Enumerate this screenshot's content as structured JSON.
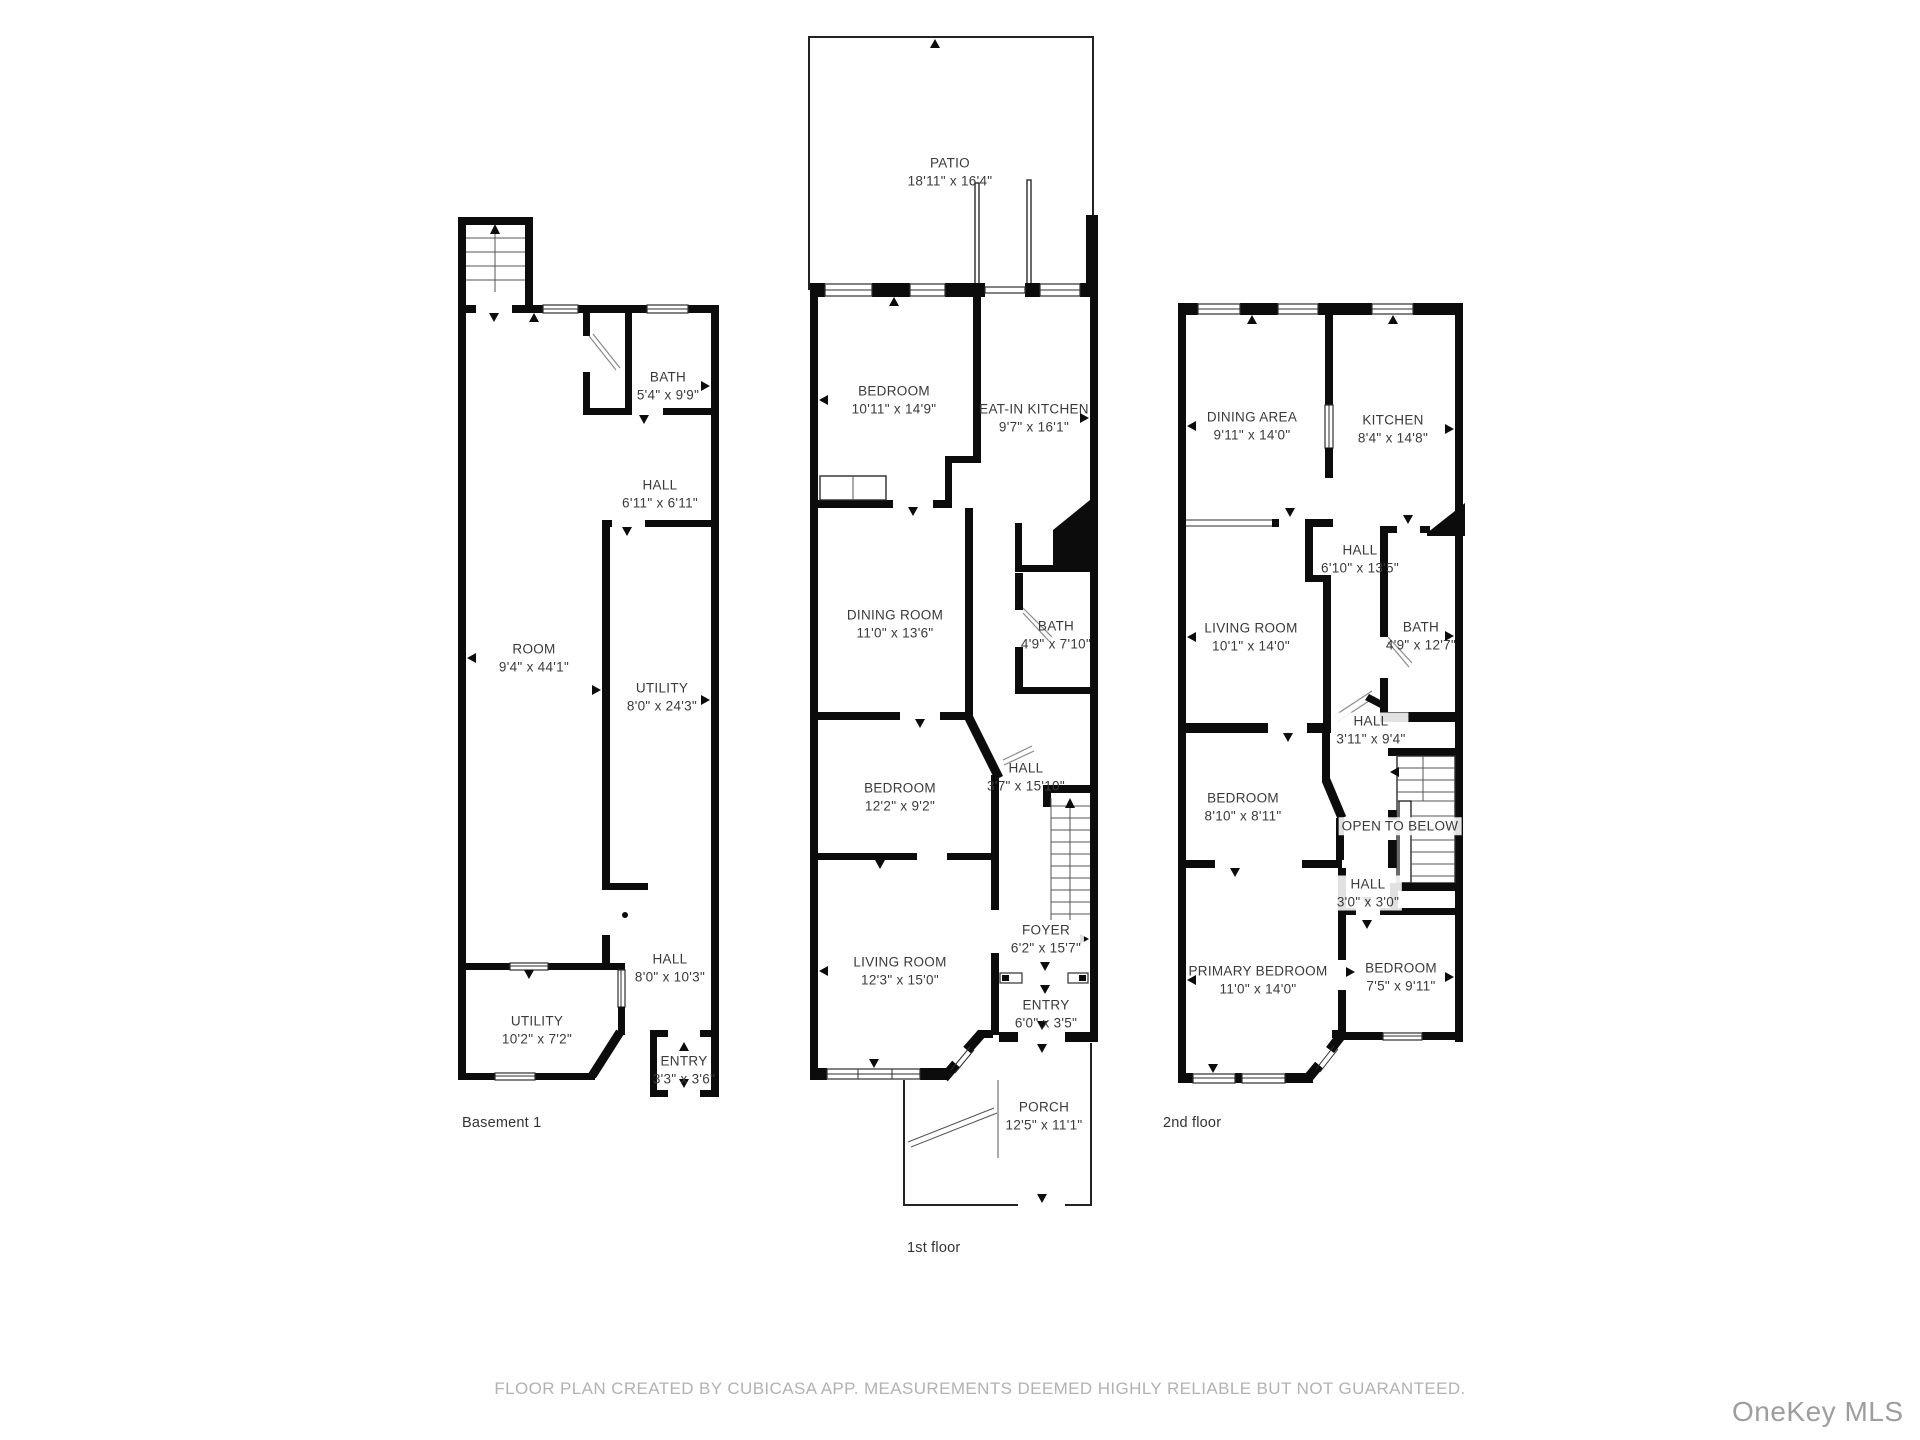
{
  "page": {
    "footer_disclaimer": "FLOOR PLAN CREATED BY CUBICASA APP. MEASUREMENTS DEEMED HIGHLY RELIABLE BUT NOT GUARANTEED.",
    "watermark": "OneKey MLS",
    "colors": {
      "wall": "#0c0c0c",
      "text": "#3a3a3a",
      "muted_text": "#b2b2b2",
      "watermark_text": "#9e9e9e",
      "background": "#ffffff"
    }
  },
  "plans": [
    {
      "floor_label": "Basement 1",
      "rooms": [
        {
          "name": "BATH",
          "dims": "5'4\" x 9'9\""
        },
        {
          "name": "HALL",
          "dims": "6'11\" x 6'11\""
        },
        {
          "name": "ROOM",
          "dims": "9'4\" x 44'1\""
        },
        {
          "name": "UTILITY",
          "dims": "8'0\" x 24'3\""
        },
        {
          "name": "HALL",
          "dims": "8'0\" x 10'3\""
        },
        {
          "name": "UTILITY",
          "dims": "10'2\" x 7'2\""
        },
        {
          "name": "ENTRY",
          "dims": "3'3\" x 3'6\""
        }
      ]
    },
    {
      "floor_label": "1st floor",
      "rooms": [
        {
          "name": "PATIO",
          "dims": "18'11\" x 16'4\""
        },
        {
          "name": "BEDROOM",
          "dims": "10'11\" x 14'9\""
        },
        {
          "name": "EAT-IN KITCHEN",
          "dims": "9'7\" x 16'1\""
        },
        {
          "name": "DINING ROOM",
          "dims": "11'0\" x 13'6\""
        },
        {
          "name": "BATH",
          "dims": "4'9\" x 7'10\""
        },
        {
          "name": "BEDROOM",
          "dims": "12'2\" x 9'2\""
        },
        {
          "name": "HALL",
          "dims": "3'7\" x 15'10\""
        },
        {
          "name": "LIVING ROOM",
          "dims": "12'3\" x 15'0\""
        },
        {
          "name": "FOYER",
          "dims": "6'2\" x 15'7\""
        },
        {
          "name": "ENTRY",
          "dims": "6'0\" x 3'5\""
        },
        {
          "name": "PORCH",
          "dims": "12'5\" x 11'1\""
        }
      ]
    },
    {
      "floor_label": "2nd floor",
      "rooms": [
        {
          "name": "DINING AREA",
          "dims": "9'11\" x 14'0\""
        },
        {
          "name": "KITCHEN",
          "dims": "8'4\" x 14'8\""
        },
        {
          "name": "HALL",
          "dims": "6'10\" x 13'5\""
        },
        {
          "name": "LIVING ROOM",
          "dims": "10'1\" x 14'0\""
        },
        {
          "name": "BATH",
          "dims": "4'9\" x 12'7\""
        },
        {
          "name": "HALL",
          "dims": "3'11\" x 9'4\""
        },
        {
          "name": "BEDROOM",
          "dims": "8'10\" x 8'11\""
        },
        {
          "name": "OPEN TO BELOW",
          "dims": ""
        },
        {
          "name": "HALL",
          "dims": "3'0\" x 3'0\""
        },
        {
          "name": "PRIMARY BEDROOM",
          "dims": "11'0\" x 14'0\""
        },
        {
          "name": "BEDROOM",
          "dims": "7'5\" x 9'11\""
        }
      ]
    }
  ]
}
